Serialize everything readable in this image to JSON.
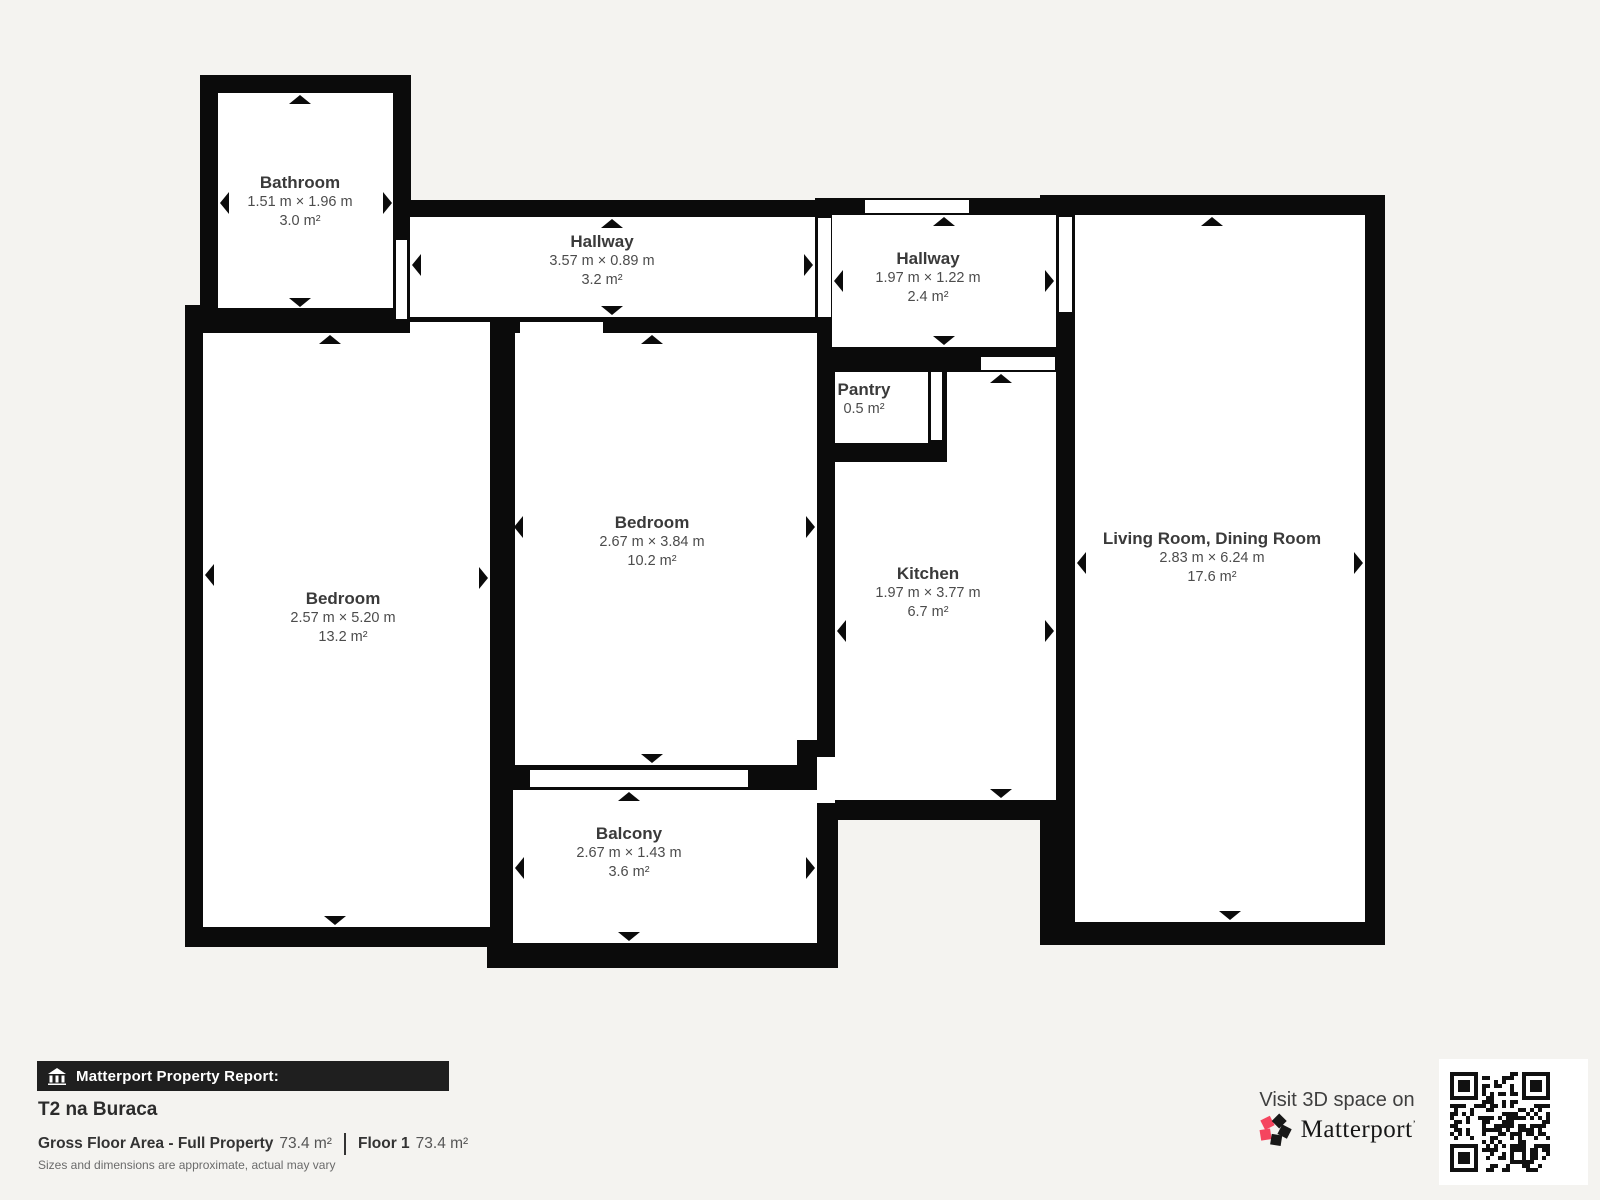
{
  "plan": {
    "rooms": [
      {
        "id": "bathroom",
        "name": "Bathroom",
        "dims": "1.51 m × 1.96 m",
        "area": "3.0 m²"
      },
      {
        "id": "hallway-top",
        "name": "Hallway",
        "dims": "3.57 m × 0.89 m",
        "area": "3.2 m²"
      },
      {
        "id": "hallway-right",
        "name": "Hallway",
        "dims": "1.97 m × 1.22 m",
        "area": "2.4 m²"
      },
      {
        "id": "pantry",
        "name": "Pantry",
        "dims": "",
        "area": "0.5 m²"
      },
      {
        "id": "bedroom-center",
        "name": "Bedroom",
        "dims": "2.67 m × 3.84 m",
        "area": "10.2 m²"
      },
      {
        "id": "bedroom-left",
        "name": "Bedroom",
        "dims": "2.57 m × 5.20 m",
        "area": "13.2 m²"
      },
      {
        "id": "kitchen",
        "name": "Kitchen",
        "dims": "1.97 m × 3.77 m",
        "area": "6.7 m²"
      },
      {
        "id": "living",
        "name": "Living Room, Dining Room",
        "dims": "2.83 m × 6.24 m",
        "area": "17.6 m²"
      },
      {
        "id": "balcony",
        "name": "Balcony",
        "dims": "2.67 m × 1.43 m",
        "area": "3.6 m²"
      }
    ]
  },
  "footer": {
    "report_label": "Matterport Property Report:",
    "property_name": "T2 na Buraca",
    "gross_label": "Gross Floor Area - Full Property",
    "gross_value": "73.4 m²",
    "floor_label": "Floor 1",
    "floor_value": "73.4 m²",
    "disclaimer": "Sizes and dimensions are approximate, actual may vary",
    "visit_label": "Visit 3D space on",
    "brand": "Matterport",
    "brand_mark": "’"
  },
  "icons": {
    "bar_icon": "building-icon",
    "logo": "matterport-pinwheel-logo",
    "qr": "qr-code"
  },
  "colors": {
    "background": "#f4f3f0",
    "wall": "#0b0b0b",
    "floor": "#ffffff",
    "bar_background": "#1f1f1f",
    "label_title": "#3a3a3a",
    "label_text": "#4c4c4c",
    "brand_pink": "#f5455f",
    "brand_black": "#181818"
  }
}
